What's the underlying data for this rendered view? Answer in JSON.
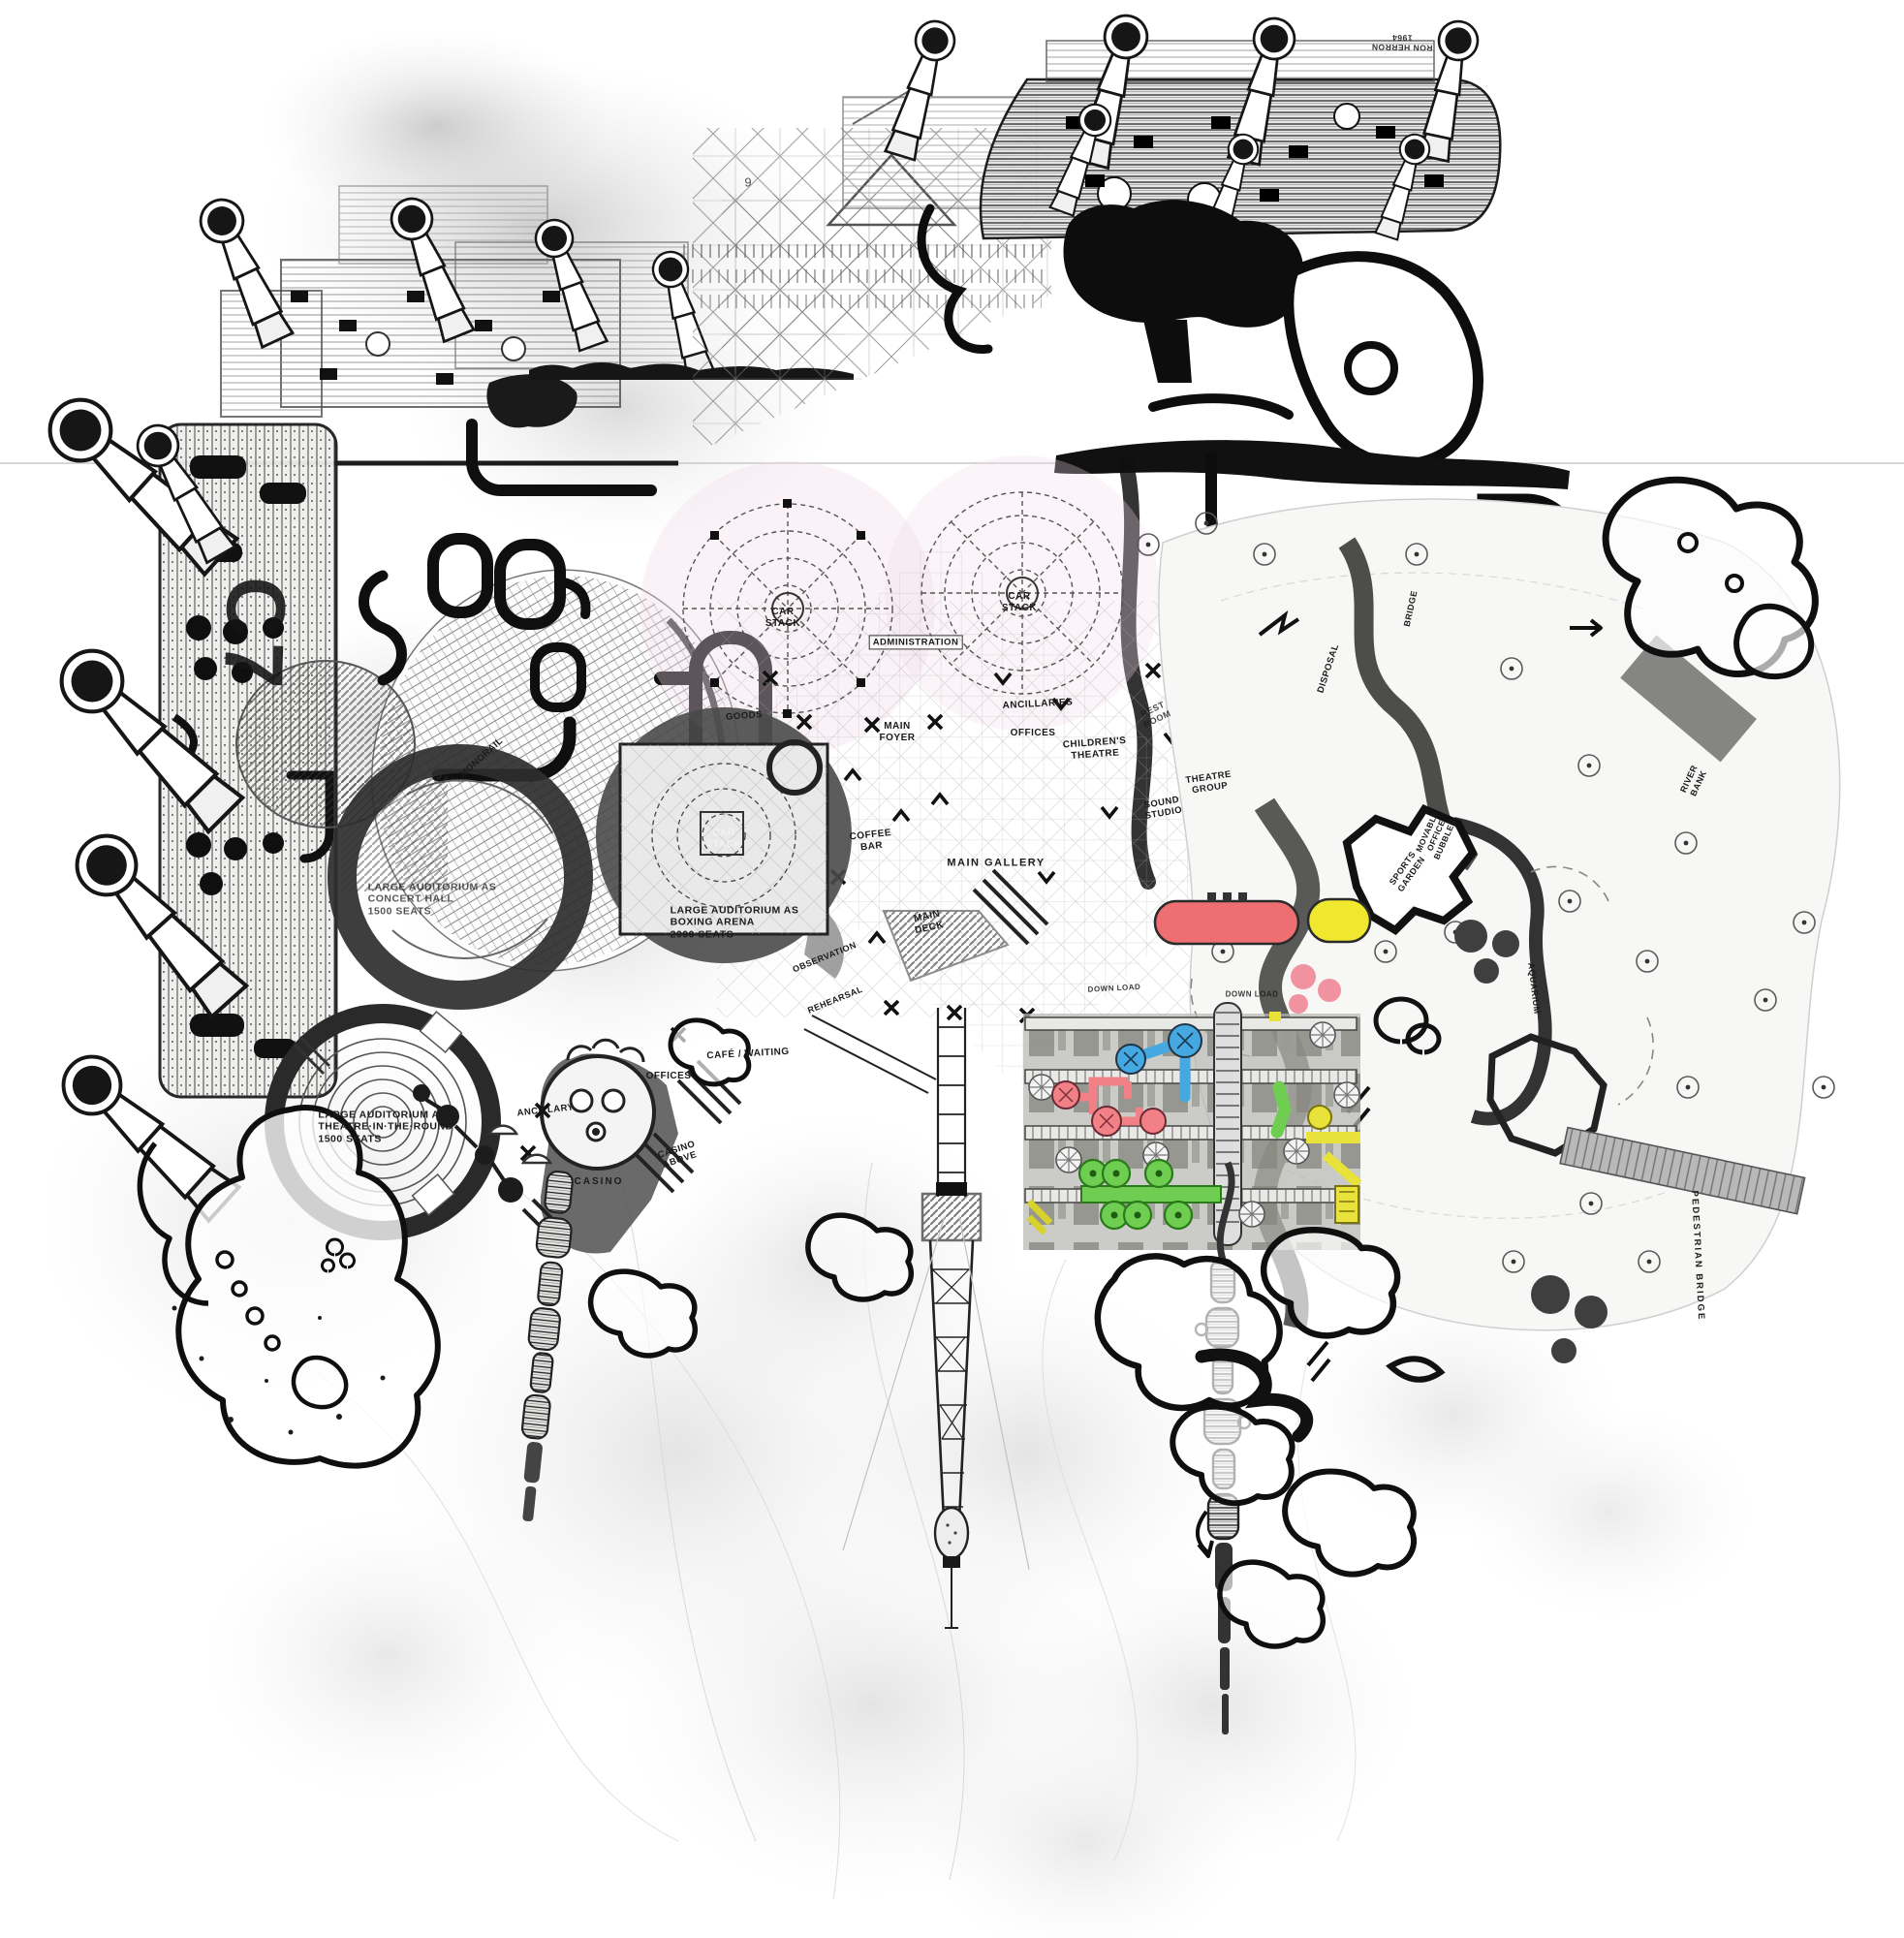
{
  "artwork": {
    "signature_line1": "RON HERRON",
    "signature_line2": "1964",
    "sheet_mark": "9",
    "grid_reference": "C7"
  },
  "labels": {
    "car_stack": "CAR\nSTACK",
    "administration": "ADMINISTRATION",
    "goods": "GOODS",
    "main_foyer": "MAIN\nFOYER",
    "ancillaries": "ANCILLARIES",
    "offices_upper": "OFFICES",
    "childrens_theatre": "CHILDREN'S\nTHEATRE",
    "rest_room": "REST\nROOM",
    "theatre_group": "THEATRE\nGROUP",
    "sound_studio": "SOUND\nSTUDIO",
    "main_gallery": "MAIN GALLERY",
    "coffee_bar": "COFFEE\nBAR",
    "main_deck": "MAIN\nDECK",
    "observation": "OBSERVATION",
    "rehearsal": "REHEARSAL",
    "auditorium_boxing": "LARGE AUDITORIUM AS\nBOXING ARENA\n2000 SEATS",
    "auditorium_concert": "LARGE AUDITORIUM AS\nCONCERT HALL\n1500 SEATS",
    "auditorium_theatre_round": "LARGE AUDITORIUM AS\nTHEATRE·IN·THE·ROUND\n1500 SEATS",
    "cafe_waiting": "CAFÉ / WAITING",
    "offices_lower": "OFFICES",
    "ancillary": "ANCILLARY",
    "casino_above": "CASINO\nABOVE",
    "casino": "CASINO",
    "monorail": "MONORAIL",
    "disposal": "DISPOSAL",
    "bridge": "BRIDGE",
    "river_bank": "RIVER\nBANK",
    "sports_garden": "SPORTS\nGARDEN",
    "movable_office_bubbles": "MOVABLE\nOFFICE\nBUBBLES",
    "aquarium": "AQUARIUM",
    "pedestrian_bridge": "PEDESTRIAN  BRIDGE",
    "down_load": "DOWN LOAD"
  },
  "colors": {
    "red_capsule": "#ee6e72",
    "yellow_capsule": "#f0e82e",
    "blue_machine": "#45a8e0",
    "pink_machine": "#f28087",
    "green_machine": "#6fce52",
    "yellow_pipes": "#e8e23a",
    "plaza_tint": "#f2dbe7"
  }
}
